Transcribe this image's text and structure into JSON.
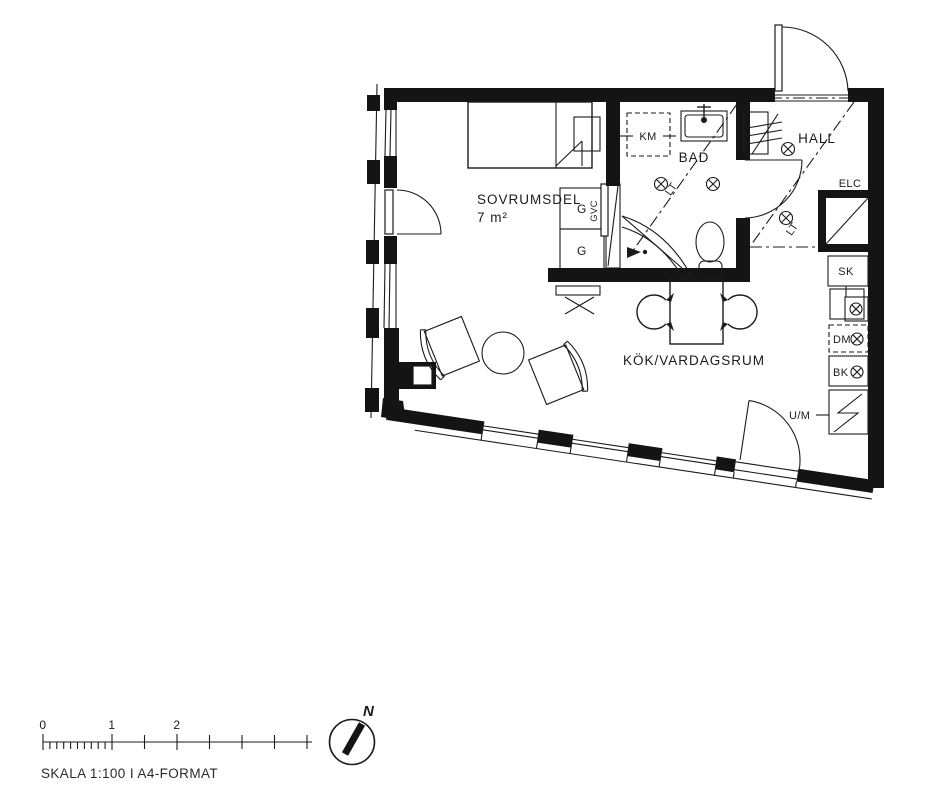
{
  "plan": {
    "bedroom": {
      "label": "SOVRUMSDEL",
      "area": "7 m²",
      "wardrobe_a": "G",
      "wardrobe_b": "G",
      "sliding_door": "GVC"
    },
    "bathroom": {
      "label": "BAD",
      "washing_machine": "KM",
      "ceiling_mark": "LT"
    },
    "hall": {
      "label": "HALL",
      "ceiling_mark": "LT",
      "electrical_cabinet": "ELC"
    },
    "kitchen": {
      "label": "KÖK/VARDAGSRUM",
      "tall_cabinet": "SK",
      "dishwasher": "DM",
      "fridge_freezer": "BK",
      "oven_microwave": "U/M"
    }
  },
  "scale_bar": {
    "tick_labels": [
      "0",
      "1",
      "2"
    ],
    "caption": "SKALA 1:100 I A4-FORMAT"
  },
  "north_arrow": {
    "label": "N"
  },
  "colors": {
    "ink": "#1b1b1b",
    "background": "#ffffff"
  }
}
